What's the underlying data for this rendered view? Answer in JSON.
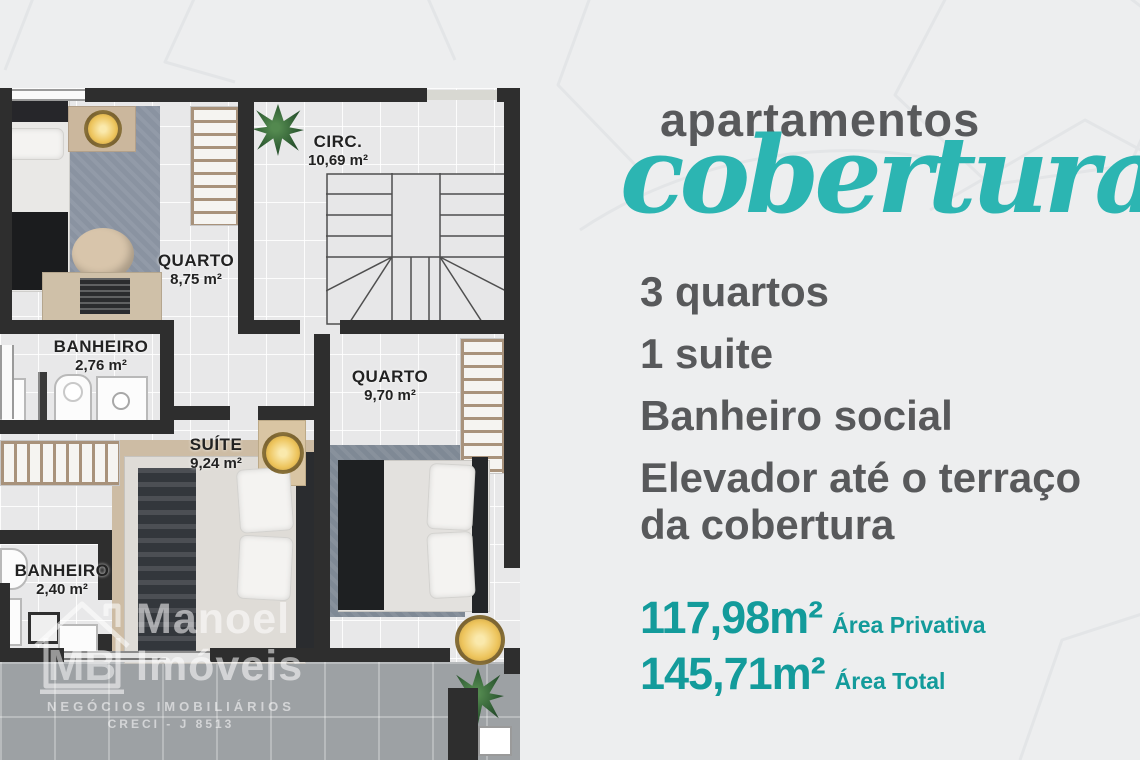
{
  "header": {
    "kicker": "apartamentos",
    "title_script": "coberturas"
  },
  "features": [
    "3 quartos",
    "1 suite",
    "Banheiro social",
    "Elevador até o terraço da cobertura"
  ],
  "areas": [
    {
      "value": "117,98m²",
      "label": "Área Privativa"
    },
    {
      "value": "145,71m²",
      "label": "Área Total"
    }
  ],
  "floorplan": {
    "rooms": [
      {
        "name": "CIRC.",
        "area": "10,69 m²"
      },
      {
        "name": "QUARTO",
        "area": "8,75 m²"
      },
      {
        "name": "BANHEIRO",
        "area": "2,76 m²"
      },
      {
        "name": "QUARTO",
        "area": "9,70 m²"
      },
      {
        "name": "SUÍTE",
        "area": "9,24 m²"
      },
      {
        "name": "BANHEIRO",
        "area": "2,40 m²"
      }
    ]
  },
  "watermark": {
    "logo_initials": "MB",
    "brand_line1": "Manoel",
    "brand_line2": "Imóveis",
    "tagline": "NEGÓCIOS IMOBILIÁRIOS",
    "creci": "CRECI - J 8513"
  },
  "colors": {
    "accent_teal": "#139B9B",
    "script_teal": "#2CB5B2",
    "text_dark": "#58595B",
    "wall": "#2E2E2E",
    "page_bg": "#EDEEEF",
    "terrace": "#9DA1A4"
  }
}
